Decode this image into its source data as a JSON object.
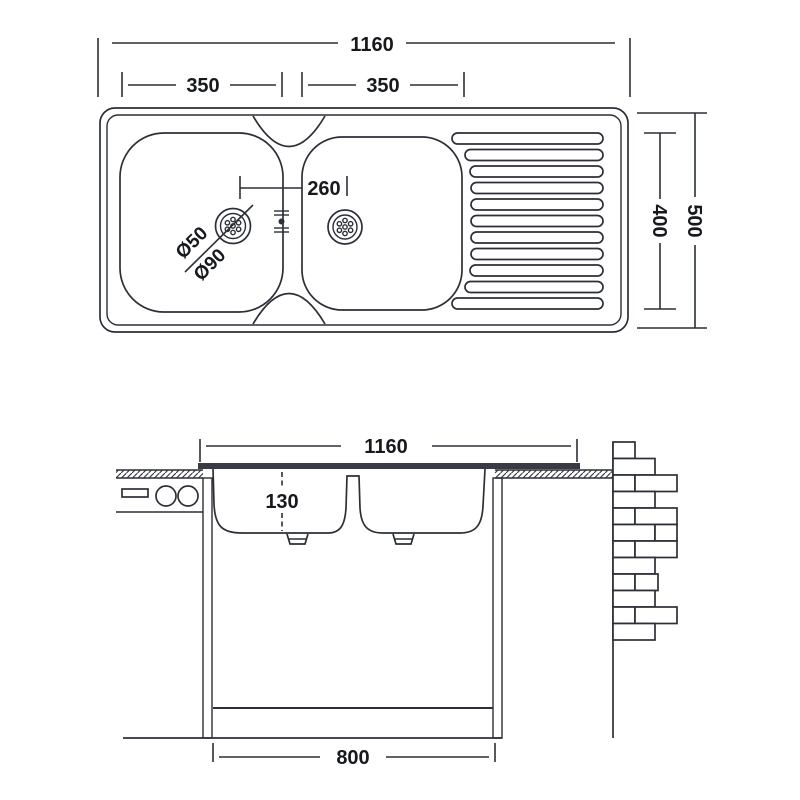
{
  "title": "Double bowl sink with drainer - dimensioned technical drawing",
  "labels": {
    "top_view": {
      "overall_width": "1160",
      "left_bowl_width": "350",
      "right_bowl_width": "350",
      "drain_center_distance": "260",
      "waste_diameter_small": "Ø50",
      "waste_diameter_large": "Ø90",
      "bowl_front_depth": "400",
      "overall_depth": "500"
    },
    "section_view": {
      "overall_width": "1160",
      "bowl_depth": "130",
      "cabinet_width": "800"
    }
  },
  "colors": {
    "line": "#2c2f37",
    "text": "#17191d",
    "rim_fill": "#383b44",
    "background": "#ffffff"
  },
  "drainer_ribs": {
    "y_start": 133,
    "pitch": 16.5,
    "height": 11,
    "right": 603,
    "lefts": [
      452,
      465,
      470,
      471,
      471,
      471,
      471,
      471,
      470,
      465,
      452
    ]
  },
  "brick_wall": {
    "x": 613,
    "row_height": 16.5,
    "rows": [
      {
        "y": 442.0,
        "segs": [
          [
            613,
            22
          ]
        ]
      },
      {
        "y": 458.5,
        "segs": [
          [
            613,
            42
          ]
        ]
      },
      {
        "y": 475.0,
        "segs": [
          [
            613,
            22
          ],
          [
            635,
            42
          ]
        ]
      },
      {
        "y": 491.5,
        "segs": [
          [
            613,
            42
          ]
        ]
      },
      {
        "y": 508.0,
        "segs": [
          [
            613,
            22
          ],
          [
            635,
            42
          ]
        ]
      },
      {
        "y": 524.5,
        "segs": [
          [
            613,
            42
          ],
          [
            655,
            22
          ]
        ]
      },
      {
        "y": 541.0,
        "segs": [
          [
            613,
            22
          ],
          [
            635,
            42
          ]
        ]
      },
      {
        "y": 557.5,
        "segs": [
          [
            613,
            42
          ]
        ]
      },
      {
        "y": 574.0,
        "segs": [
          [
            613,
            22
          ],
          [
            635,
            23
          ]
        ]
      },
      {
        "y": 590.5,
        "segs": [
          [
            613,
            42
          ]
        ]
      },
      {
        "y": 607.0,
        "segs": [
          [
            613,
            22
          ],
          [
            635,
            42
          ]
        ]
      },
      {
        "y": 623.5,
        "segs": [
          [
            613,
            42
          ]
        ]
      }
    ]
  }
}
